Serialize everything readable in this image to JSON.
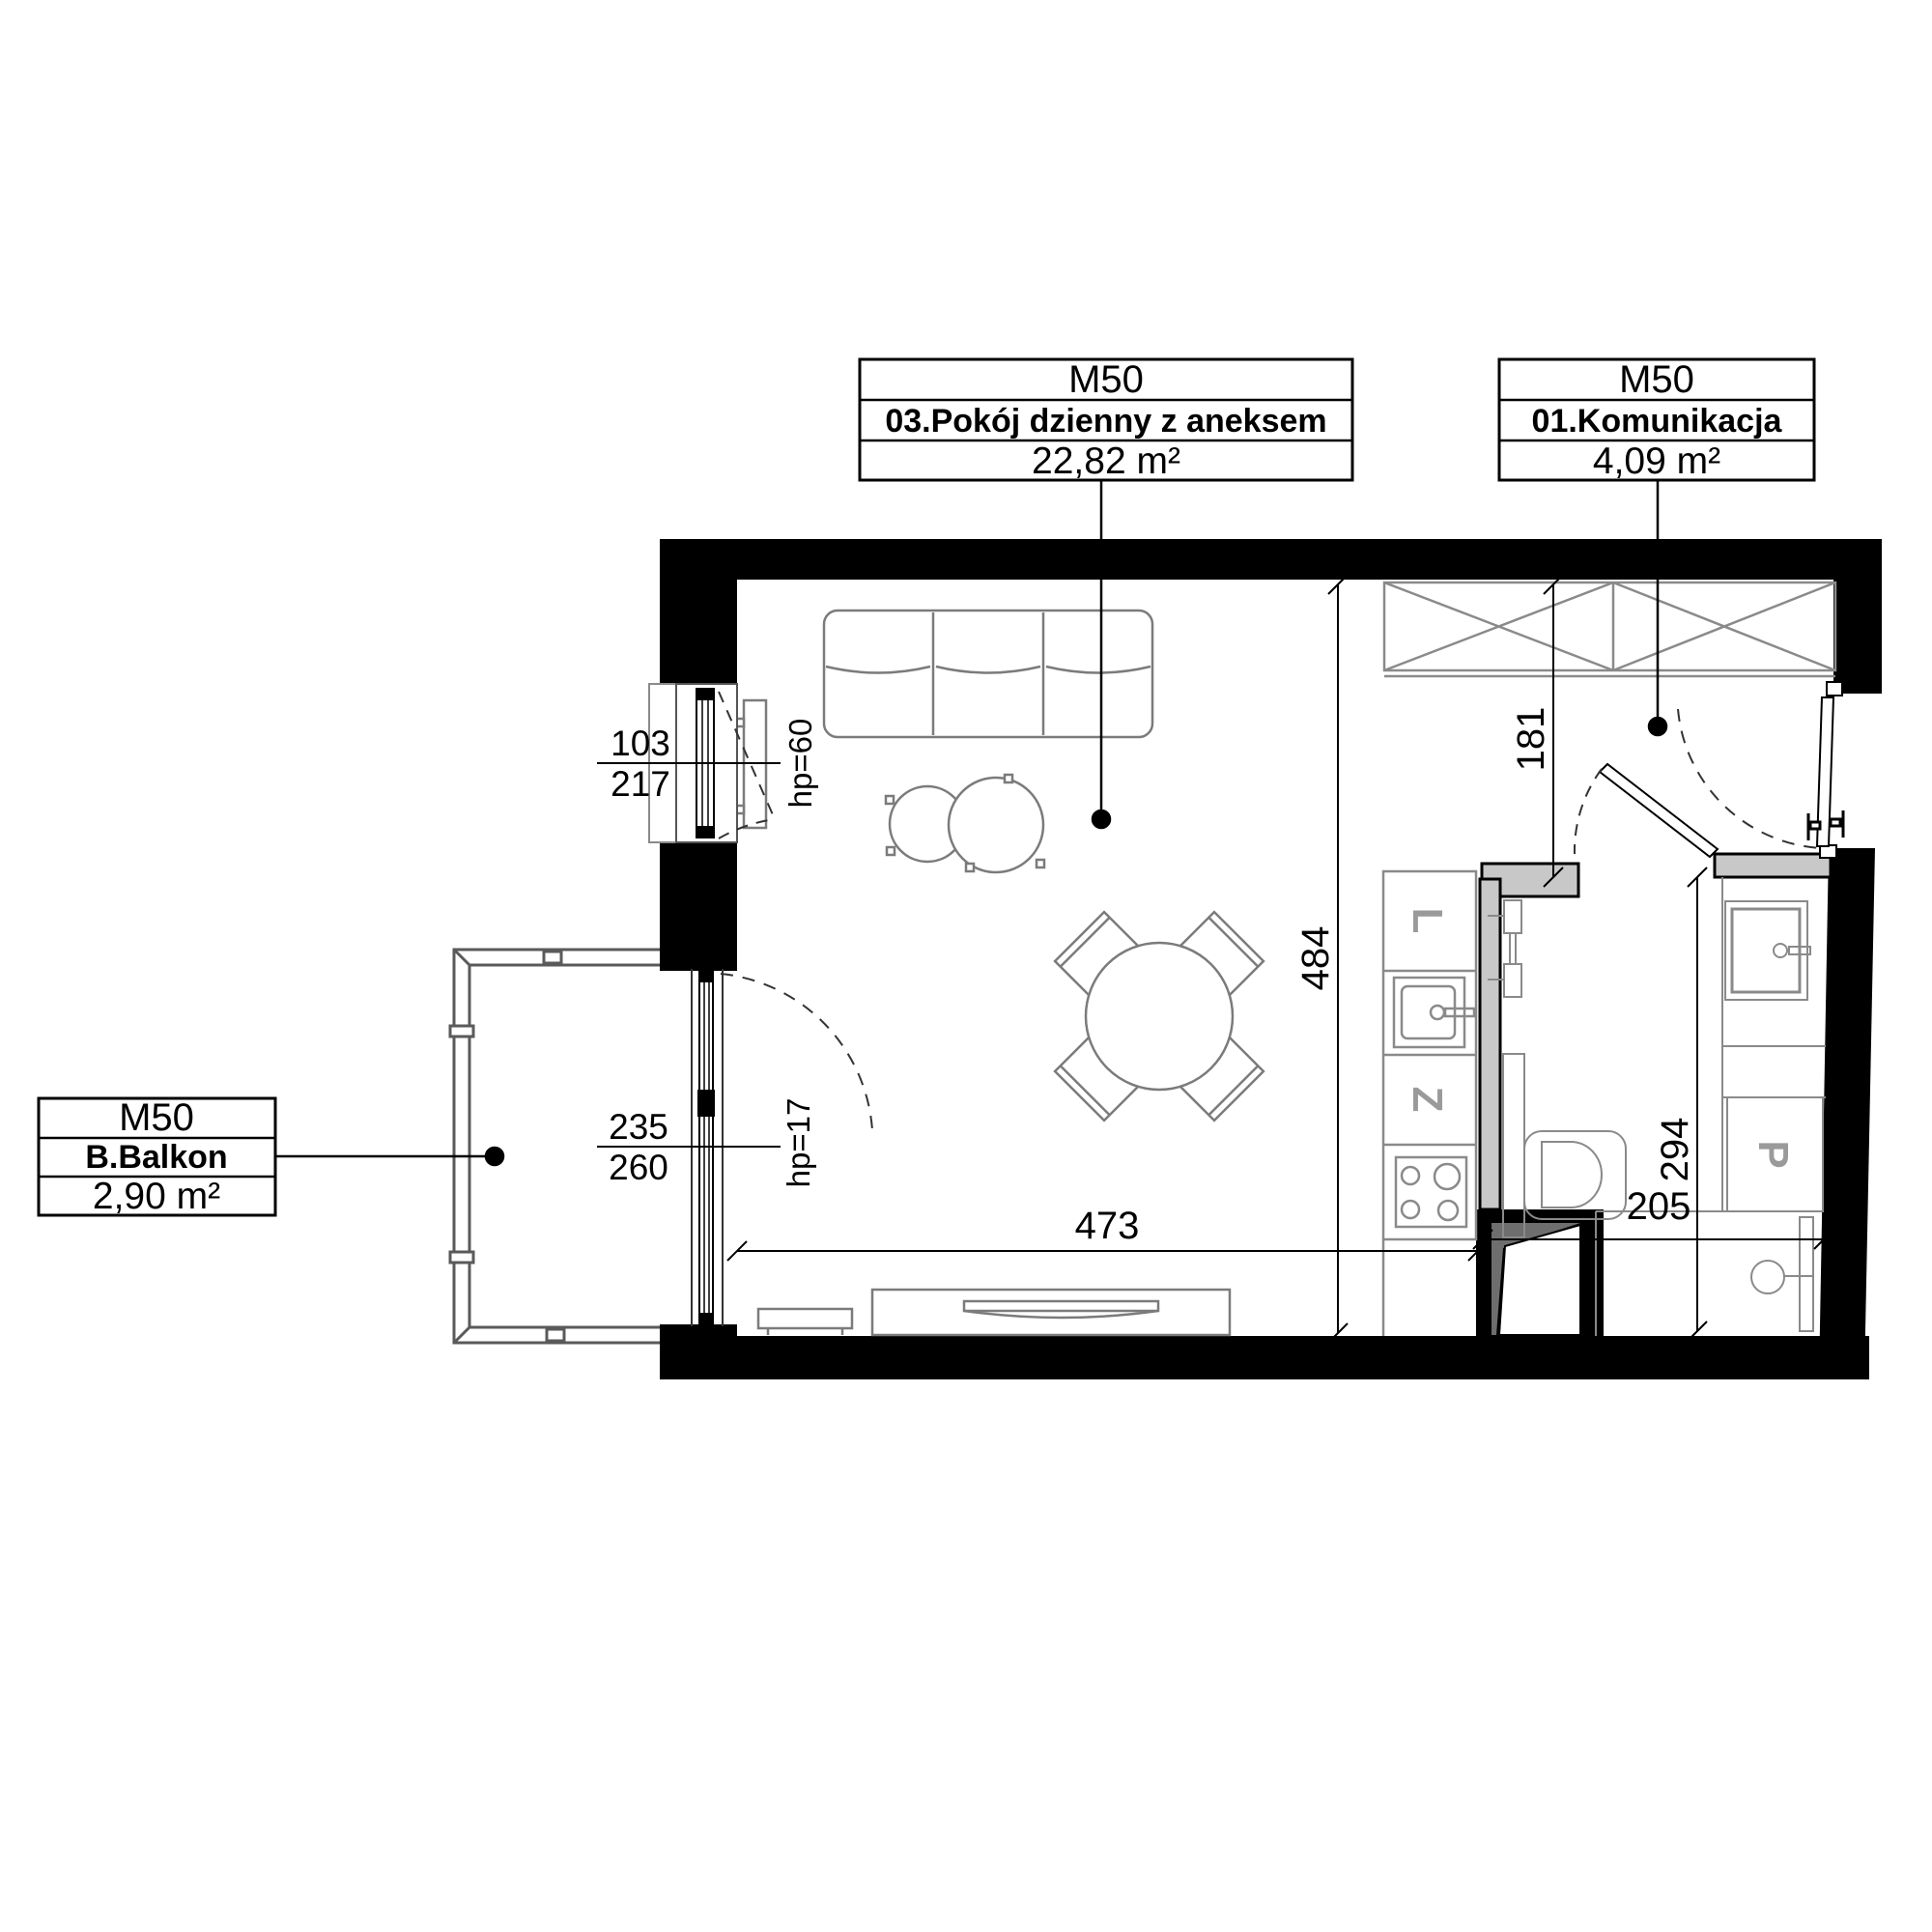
{
  "plan_title": "Apartment unit floor plan",
  "unit_code": "M50",
  "labels": {
    "living": {
      "unit": "M50",
      "name": "03.Pokój dzienny z aneksem",
      "area": "22,82 m²"
    },
    "hall": {
      "unit": "M50",
      "name": "01.Komunikacja",
      "area": "4,09 m²"
    },
    "balcony": {
      "unit": "M50",
      "name": "B.Balkon",
      "area": "2,90 m²"
    }
  },
  "dimensions": {
    "living_width": "473",
    "living_height": "484",
    "hall_height": "181",
    "bath_height": "294",
    "bath_width": "205",
    "window_width": "103",
    "window_width_total": "217",
    "window_parapet": "hp=60",
    "balcony_door_width": "235",
    "balcony_door_width_total": "260",
    "balcony_door_parapet": "hp=17"
  },
  "fixtures": {
    "fridge_letter": "L",
    "dishwasher_letter": "Z",
    "washer_letter": "P"
  },
  "colors": {
    "wall": "#000000",
    "partition_fill": "#c8c8c8",
    "furniture_stroke": "#7b7b7b",
    "fixture_stroke": "#8a8a8a",
    "background": "#ffffff"
  }
}
